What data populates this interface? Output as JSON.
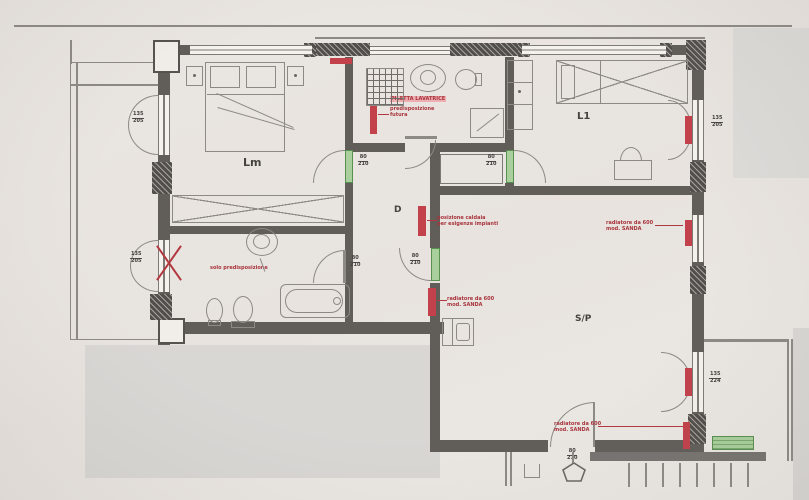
{
  "document": {
    "kind": "apartment floor plan (scanned photo)"
  },
  "colors": {
    "paper": "#e9e5e1",
    "wall": "#615d59",
    "mask_grey": "#d8d7d3",
    "door_green": "#a9cf9c",
    "marker_red": "#c2414b",
    "annotation_red": "#a8343c"
  },
  "rooms": {
    "lm": "Lm",
    "l1": "L1",
    "corridor": "D",
    "living": "S/P"
  },
  "dims": {
    "win_left_upper": {
      "w": "135",
      "h": "205"
    },
    "win_left_lower": {
      "w": "135",
      "h": "205"
    },
    "win_right_l1": {
      "w": "135",
      "h": "205"
    },
    "frenchdoor_right": {
      "w": "135",
      "h": "224"
    },
    "door_lm": {
      "w": "80",
      "h": "210"
    },
    "door_l1": {
      "w": "80",
      "h": "210"
    },
    "door_bath2": {
      "w": "80",
      "h": "210"
    },
    "door_living": {
      "w": "80",
      "h": "210"
    },
    "door_entry": {
      "w": "80",
      "h": "210"
    }
  },
  "annotations": {
    "bath1": {
      "highlight": "PILETTA LAVATRICE",
      "line1": "predisposizione",
      "line2": "futura"
    },
    "bath2": {
      "line1": "solo predisposizione"
    },
    "corridor": {
      "line1": "posizione caldaia",
      "line2": "per esigenze impianti"
    },
    "living_left": {
      "line1": "radiatore da 600",
      "line2": "mod. SANDA"
    },
    "living_right": {
      "line1": "radiatore da 600",
      "line2": "mod. SANDA"
    },
    "living_bottom": {
      "line1": "radiatore da 600",
      "line2": "mod. SANDA"
    }
  }
}
